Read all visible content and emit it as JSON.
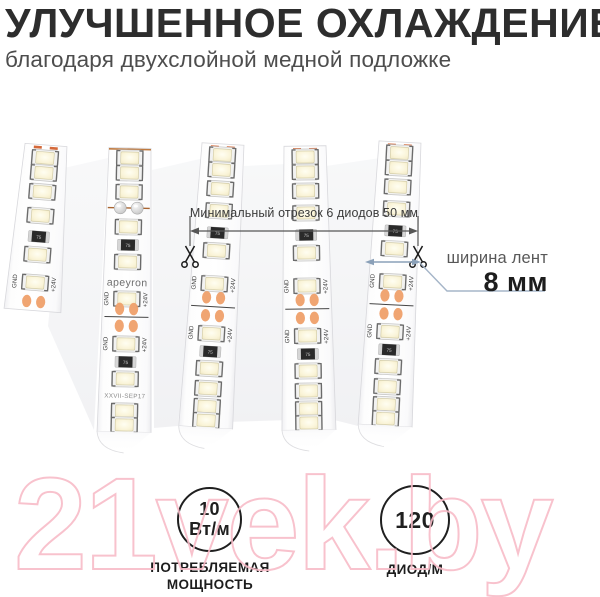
{
  "header": {
    "title": "УЛУЧШЕННОЕ ОХЛАЖДЕНИЕ",
    "subtitle": "благодаря двухслойной медной подложке"
  },
  "diagram": {
    "segment_note": "Минимальный отрезок 6 диодов 50 мм",
    "width_label": "ширина лент",
    "width_value": "8 мм",
    "strip_markings": {
      "brand": "apeyron",
      "batch": "XXVII-SEP17",
      "gnd": "GND",
      "v24": "+24V",
      "resistor_code": "75"
    },
    "colors": {
      "copper_pad": "#efa06a",
      "copper_line": "#bf7a40",
      "callout_blue": "#8aa0b8",
      "dimension_gray": "#565656"
    }
  },
  "badges": [
    {
      "value_line1": "10",
      "value_line2": "Вт/м",
      "label_line1": "ПОТРЕБЛЯЕМАЯ",
      "label_line2": "МОЩНОСТЬ"
    },
    {
      "value_line1": "120",
      "label_line1": "ДИОД/М"
    }
  ],
  "watermark": {
    "text": "21vek.by",
    "color": "#f8bcc8"
  }
}
